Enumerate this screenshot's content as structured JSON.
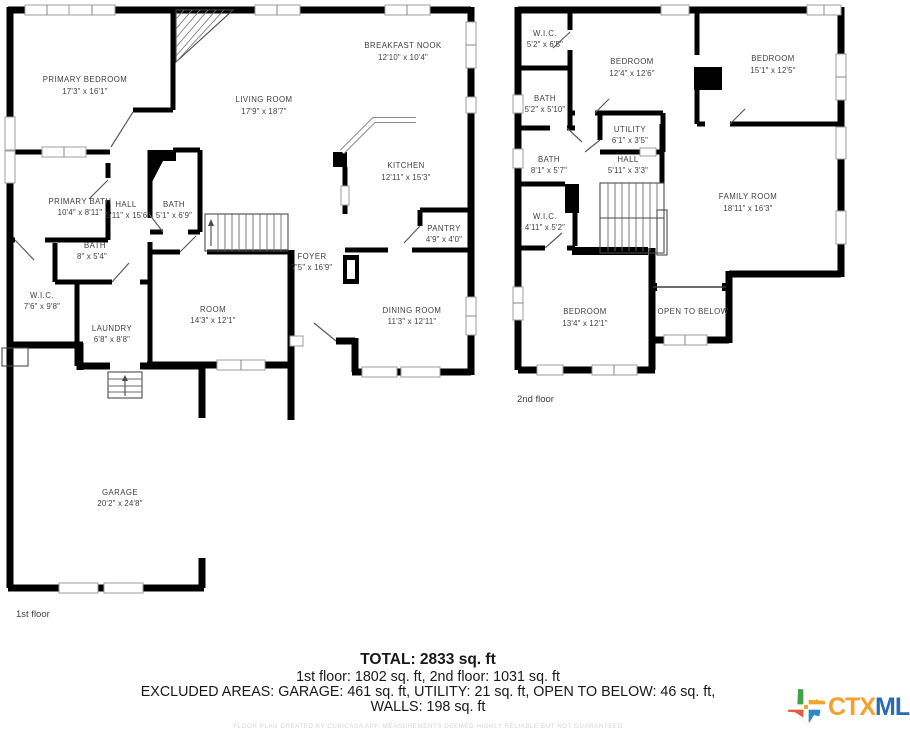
{
  "page": {
    "background": "#ffffff"
  },
  "floor1": {
    "caption": "1st floor",
    "rooms": {
      "primary_bedroom": {
        "name": "PRIMARY BEDROOM",
        "dims": "17'3\" x 16'1\""
      },
      "living_room": {
        "name": "LIVING ROOM",
        "dims": "17'9\" x 18'7\""
      },
      "breakfast_nook": {
        "name": "BREAKFAST NOOK",
        "dims": "12'10\" x 10'4\""
      },
      "kitchen": {
        "name": "KITCHEN",
        "dims": "12'11\" x 15'3\""
      },
      "pantry": {
        "name": "PANTRY",
        "dims": "4'9\" x 4'0\""
      },
      "primary_bath": {
        "name": "PRIMARY BATH",
        "dims": "10'4\" x 8'11\""
      },
      "hall": {
        "name": "HALL",
        "dims": "5'11\" x 15'6\""
      },
      "bath": {
        "name": "BATH",
        "dims": "5'1\" x 6'9\""
      },
      "bath_small": {
        "name": "BATH",
        "dims": "8\" x 5'4\""
      },
      "wic": {
        "name": "W.I.C.",
        "dims": "7'6\" x 9'8\""
      },
      "laundry": {
        "name": "LAUNDRY",
        "dims": "6'8\" x 8'8\""
      },
      "room": {
        "name": "ROOM",
        "dims": "14'3\" x 12'1\""
      },
      "foyer": {
        "name": "FOYER",
        "dims": "7'5\" x 16'9\""
      },
      "dining_room": {
        "name": "DINING ROOM",
        "dims": "11'3\" x 12'11\""
      },
      "garage": {
        "name": "GARAGE",
        "dims": "20'2\" x 24'8\""
      }
    }
  },
  "floor2": {
    "caption": "2nd floor",
    "rooms": {
      "wic1": {
        "name": "W.I.C.",
        "dims": "5'2\" x 6'5\""
      },
      "bedroom1": {
        "name": "BEDROOM",
        "dims": "12'4\" x 12'6\""
      },
      "bedroom2": {
        "name": "BEDROOM",
        "dims": "15'1\" x 12'5\""
      },
      "bath1": {
        "name": "BATH",
        "dims": "5'2\" x 5'10\""
      },
      "utility": {
        "name": "UTILITY",
        "dims": "6'1\" x 3'5\""
      },
      "bath2": {
        "name": "BATH",
        "dims": "8'1\" x 5'7\""
      },
      "hall": {
        "name": "HALL",
        "dims": "5'11\" x 3'3\""
      },
      "family_room": {
        "name": "FAMILY ROOM",
        "dims": "18'11\" x 16'3\""
      },
      "wic2": {
        "name": "W.I.C.",
        "dims": "4'11\" x 5'2\""
      },
      "bedroom3": {
        "name": "BEDROOM",
        "dims": "13'4\" x 12'1\""
      },
      "open_below": {
        "name": "OPEN TO BELOW",
        "dims": ""
      }
    }
  },
  "summary": {
    "total": "TOTAL: 2833 sq. ft",
    "floors_line": "1st floor: 1802 sq. ft, 2nd floor: 1031 sq. ft",
    "excluded_line": "EXCLUDED AREAS: GARAGE: 461 sq. ft, UTILITY: 21 sq. ft, OPEN TO BELOW: 46 sq. ft,",
    "walls_line": "WALLS: 198 sq. ft",
    "disclaimer": "FLOOR PLAN CREATED BY CUBICASA APP. MEASUREMENTS DEEMED HIGHLY RELIABLE BUT NOT GUARANTEED"
  },
  "logo": {
    "ctx": "CTX",
    "mls": "MLS",
    "ctx_color": "#F5A02A",
    "mls_color": "#2A6CB3",
    "texas_colors": {
      "top_left": "#44A148",
      "top_right": "#F6A323",
      "bottom_left": "#E25B3C",
      "bottom_right": "#2F89C5"
    }
  }
}
